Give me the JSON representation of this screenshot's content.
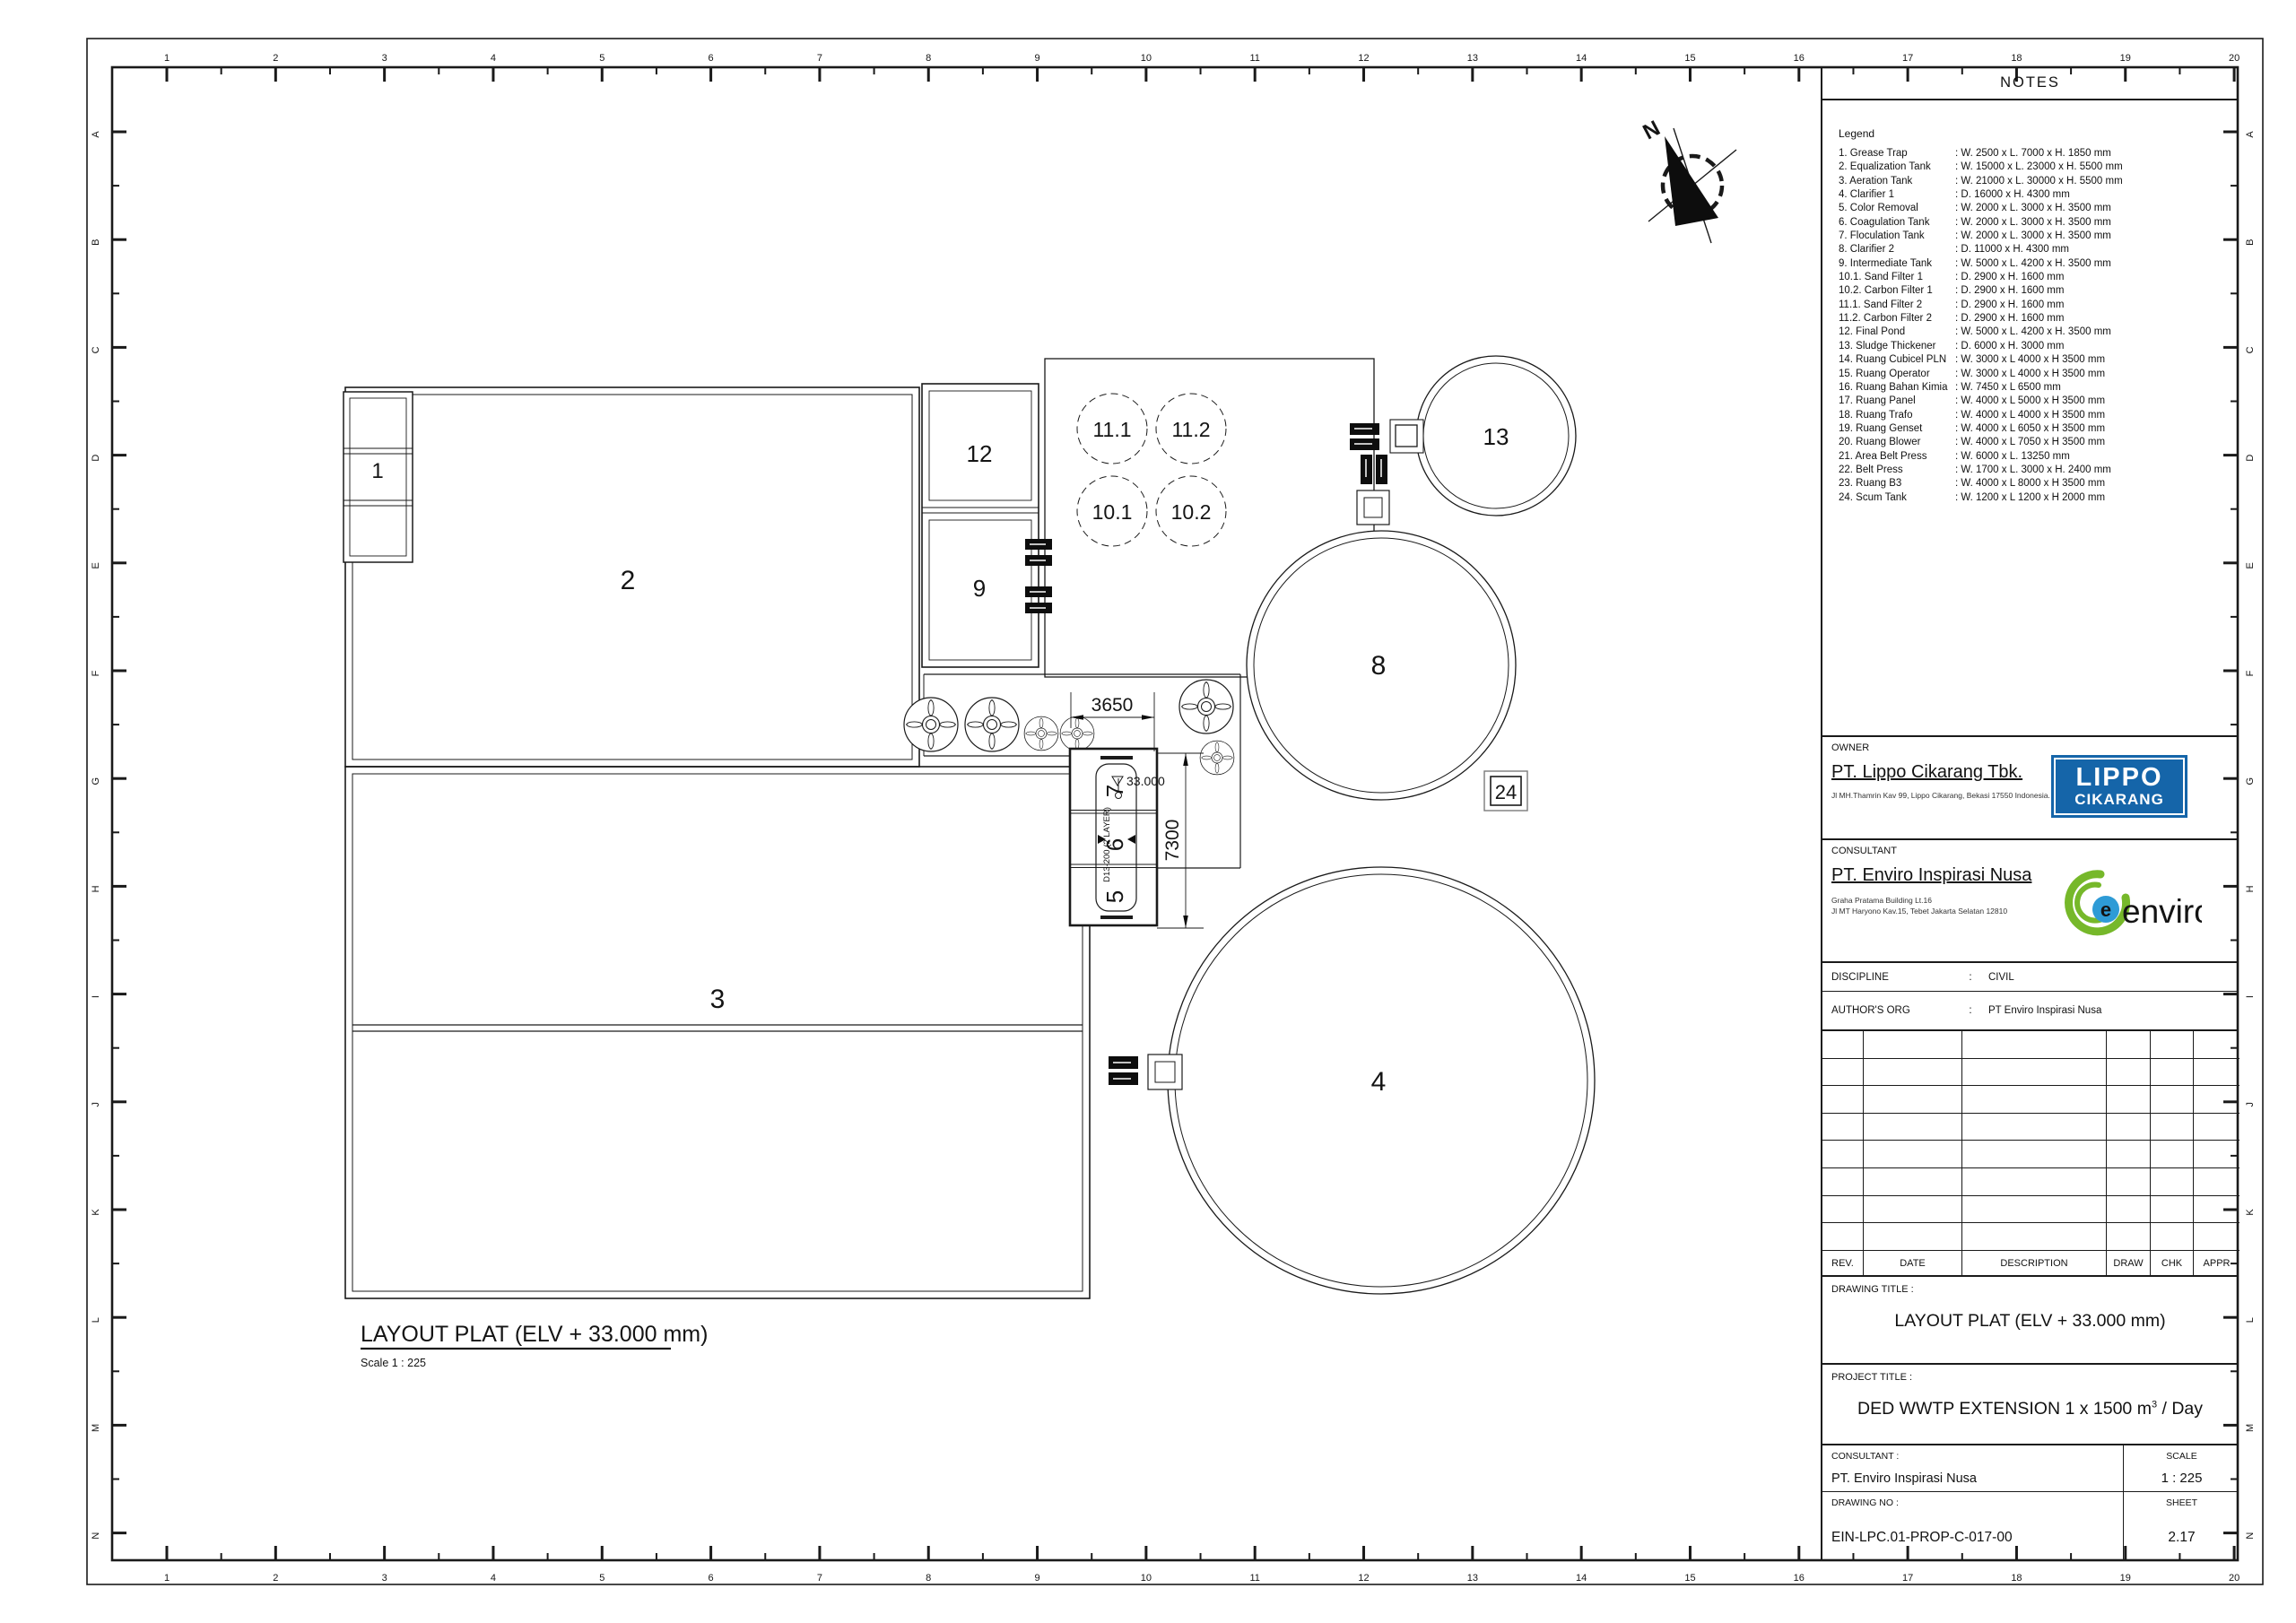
{
  "ruler": {
    "numbers": [
      "1",
      "2",
      "3",
      "4",
      "5",
      "6",
      "7",
      "8",
      "9",
      "10",
      "11",
      "12",
      "13",
      "14",
      "15",
      "16",
      "17",
      "18",
      "19",
      "20"
    ],
    "letters": [
      "A",
      "B",
      "C",
      "D",
      "E",
      "F",
      "G",
      "H",
      "I",
      "J",
      "K",
      "L",
      "M",
      "N"
    ]
  },
  "plan": {
    "caption": {
      "title": "LAYOUT PLAT (ELV + 33.000  mm)",
      "scale": "Scale 1 : 225"
    },
    "north_label": "N",
    "labels": {
      "grease_trap": "1",
      "equalization_tank": "2",
      "aeration_tank": "3",
      "clarifier_1": "4",
      "color_removal": "5",
      "coagulation_tank": "6",
      "floculation_tank": "7",
      "clarifier_2": "8",
      "intermediate_tank": "9",
      "sand_filter_1": "10.1",
      "carbon_filter_1": "10.2",
      "sand_filter_2": "11.1",
      "carbon_filter_2": "11.2",
      "final_pond": "12",
      "sludge_thickener": "13",
      "scum_tank": "24"
    },
    "dimensions": {
      "width_dim": "3650",
      "height_dim": "7300",
      "elevation": "33.000",
      "rebar_note": "D13-200 (2 LAYER)"
    }
  },
  "titleblock": {
    "notes_title": "NOTES",
    "legend_title": "Legend",
    "legend_items": [
      {
        "label": "1. Grease Trap",
        "spec": ": W. 2500 x L. 7000 x H. 1850 mm"
      },
      {
        "label": "2. Equalization Tank",
        "spec": ": W. 15000 x L. 23000 x H. 5500 mm"
      },
      {
        "label": "3. Aeration Tank",
        "spec": ": W. 21000 x L. 30000 x H. 5500 mm"
      },
      {
        "label": "4. Clarifier 1",
        "spec": ": D. 16000 x H. 4300 mm"
      },
      {
        "label": "5. Color Removal",
        "spec": ": W. 2000 x L. 3000 x H. 3500 mm"
      },
      {
        "label": "6. Coagulation Tank",
        "spec": ": W. 2000 x L. 3000 x H. 3500 mm"
      },
      {
        "label": "7. Floculation Tank",
        "spec": ": W. 2000 x L. 3000 x H. 3500 mm"
      },
      {
        "label": "8. Clarifier 2",
        "spec": ": D. 11000 x H. 4300 mm"
      },
      {
        "label": "9. Intermediate Tank",
        "spec": ": W. 5000 x L. 4200 x H. 3500 mm"
      },
      {
        "label": "10.1. Sand Filter 1",
        "spec": ": D. 2900 x H. 1600 mm"
      },
      {
        "label": "10.2. Carbon Filter 1",
        "spec": ": D. 2900 x H. 1600 mm"
      },
      {
        "label": "11.1. Sand Filter 2",
        "spec": ": D. 2900 x H. 1600 mm"
      },
      {
        "label": "11.2. Carbon Filter 2",
        "spec": ": D. 2900 x H. 1600 mm"
      },
      {
        "label": "12. Final Pond",
        "spec": ": W. 5000 x L. 4200 x H. 3500 mm"
      },
      {
        "label": "13. Sludge Thickener",
        "spec": ": D. 6000 x H. 3000 mm"
      },
      {
        "label": "14. Ruang Cubicel PLN",
        "spec": ": W. 3000 x L 4000 x H 3500 mm"
      },
      {
        "label": "15. Ruang Operator",
        "spec": ": W. 3000 x L 4000 x H 3500 mm"
      },
      {
        "label": "16. Ruang Bahan Kimia",
        "spec": ": W. 7450 x L 6500 mm"
      },
      {
        "label": "17. Ruang Panel",
        "spec": ": W. 4000 x L 5000 x H 3500 mm"
      },
      {
        "label": "18. Ruang Trafo",
        "spec": ": W. 4000 x L 4000 x H 3500 mm"
      },
      {
        "label": "19. Ruang Genset",
        "spec": ": W. 4000 x L 6050 x H 3500 mm"
      },
      {
        "label": "20. Ruang Blower",
        "spec": ": W. 4000 x L 7050 x H 3500 mm"
      },
      {
        "label": "21. Area Belt Press",
        "spec": ": W. 6000 x L. 13250 mm"
      },
      {
        "label": "22. Belt Press",
        "spec": ": W. 1700 x L. 3000 x H. 2400 mm"
      },
      {
        "label": "23. Ruang B3",
        "spec": ": W. 4000 x L 8000 x H 3500 mm"
      },
      {
        "label": "24. Scum Tank",
        "spec": ": W. 1200 x L 1200 x H 2000 mm"
      }
    ],
    "owner": {
      "label": "OWNER",
      "company": "PT. Lippo Cikarang Tbk.",
      "address": "Jl MH.Thamrin Kav 99, Lippo Cikarang, Bekasi 17550 Indonesia.",
      "logo_line1": "LIPPO",
      "logo_line2": "CIKARANG"
    },
    "consultant": {
      "label": "CONSULTANT",
      "company": "PT. Enviro Inspirasi Nusa",
      "address1": "Graha Pratama Building Lt.16",
      "address2": "Jl MT Haryono Kav.15, Tebet Jakarta Selatan 12810",
      "logo_text": "enviro",
      "logo_e": "e"
    },
    "discipline": {
      "label": "DISCIPLINE",
      "sep": ":",
      "value": "CIVIL"
    },
    "authors_org": {
      "label": "AUTHOR'S ORG",
      "sep": ":",
      "value": "PT Enviro Inspirasi Nusa"
    },
    "revision": {
      "headers": [
        "REV.",
        "DATE",
        "DESCRIPTION",
        "DRAW",
        "CHK",
        "APPR"
      ],
      "empty_rows": 8
    },
    "drawing_title": {
      "label": "DRAWING TITLE :",
      "value": "LAYOUT PLAT (ELV + 33.000 mm)"
    },
    "project_title": {
      "label": "PROJECT TITLE :",
      "value_prefix": "DED WWTP EXTENSION 1 x 1500 m",
      "sup": "3",
      "value_suffix": " / Day"
    },
    "consultant_row": {
      "label": "CONSULTANT :",
      "value": "PT. Enviro Inspirasi Nusa"
    },
    "scale": {
      "label": "SCALE",
      "value": "1 : 225"
    },
    "drawing_no": {
      "label": "DRAWING NO :",
      "value": "EIN-LPC.01-PROP-C-017-00"
    },
    "sheet_no": {
      "label": "SHEET",
      "value": "2.17"
    },
    "colors": {
      "lippo_blue": "#1565A9",
      "enviro_green": "#76B82A",
      "enviro_blue": "#2E9BD6"
    }
  }
}
